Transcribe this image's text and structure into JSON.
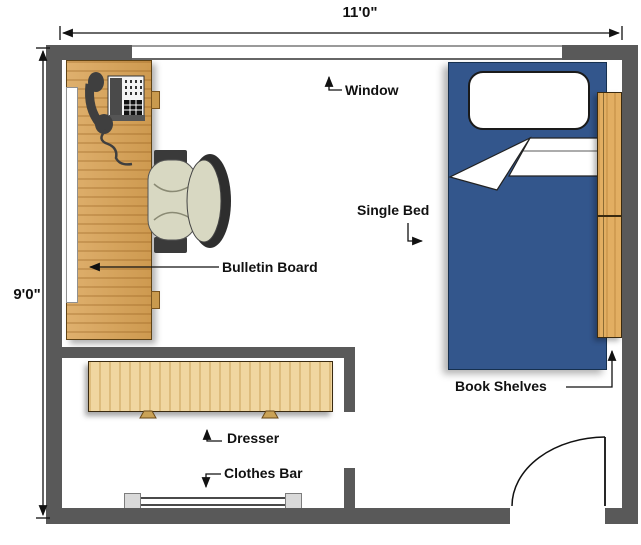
{
  "floor_plan": {
    "room_width": "11'0\"",
    "room_height": "9'0\"",
    "labels": {
      "window": "Window",
      "single_bed": "Single Bed",
      "bulletin_board": "Bulletin Board",
      "book_shelves": "Book Shelves",
      "dresser": "Dresser",
      "clothes_bar": "Clothes Bar"
    },
    "colors": {
      "wall": "#595959",
      "bed": "#33568c",
      "pillow": "#ffffff",
      "desk_wood": "#d9a254",
      "dresser_wood": "#f0d6a0",
      "shelf_wood": "#e2ae62",
      "chair_cushion": "#d8d8c2",
      "chair_frame": "#3a3a3a",
      "annotation": "#111111"
    }
  }
}
